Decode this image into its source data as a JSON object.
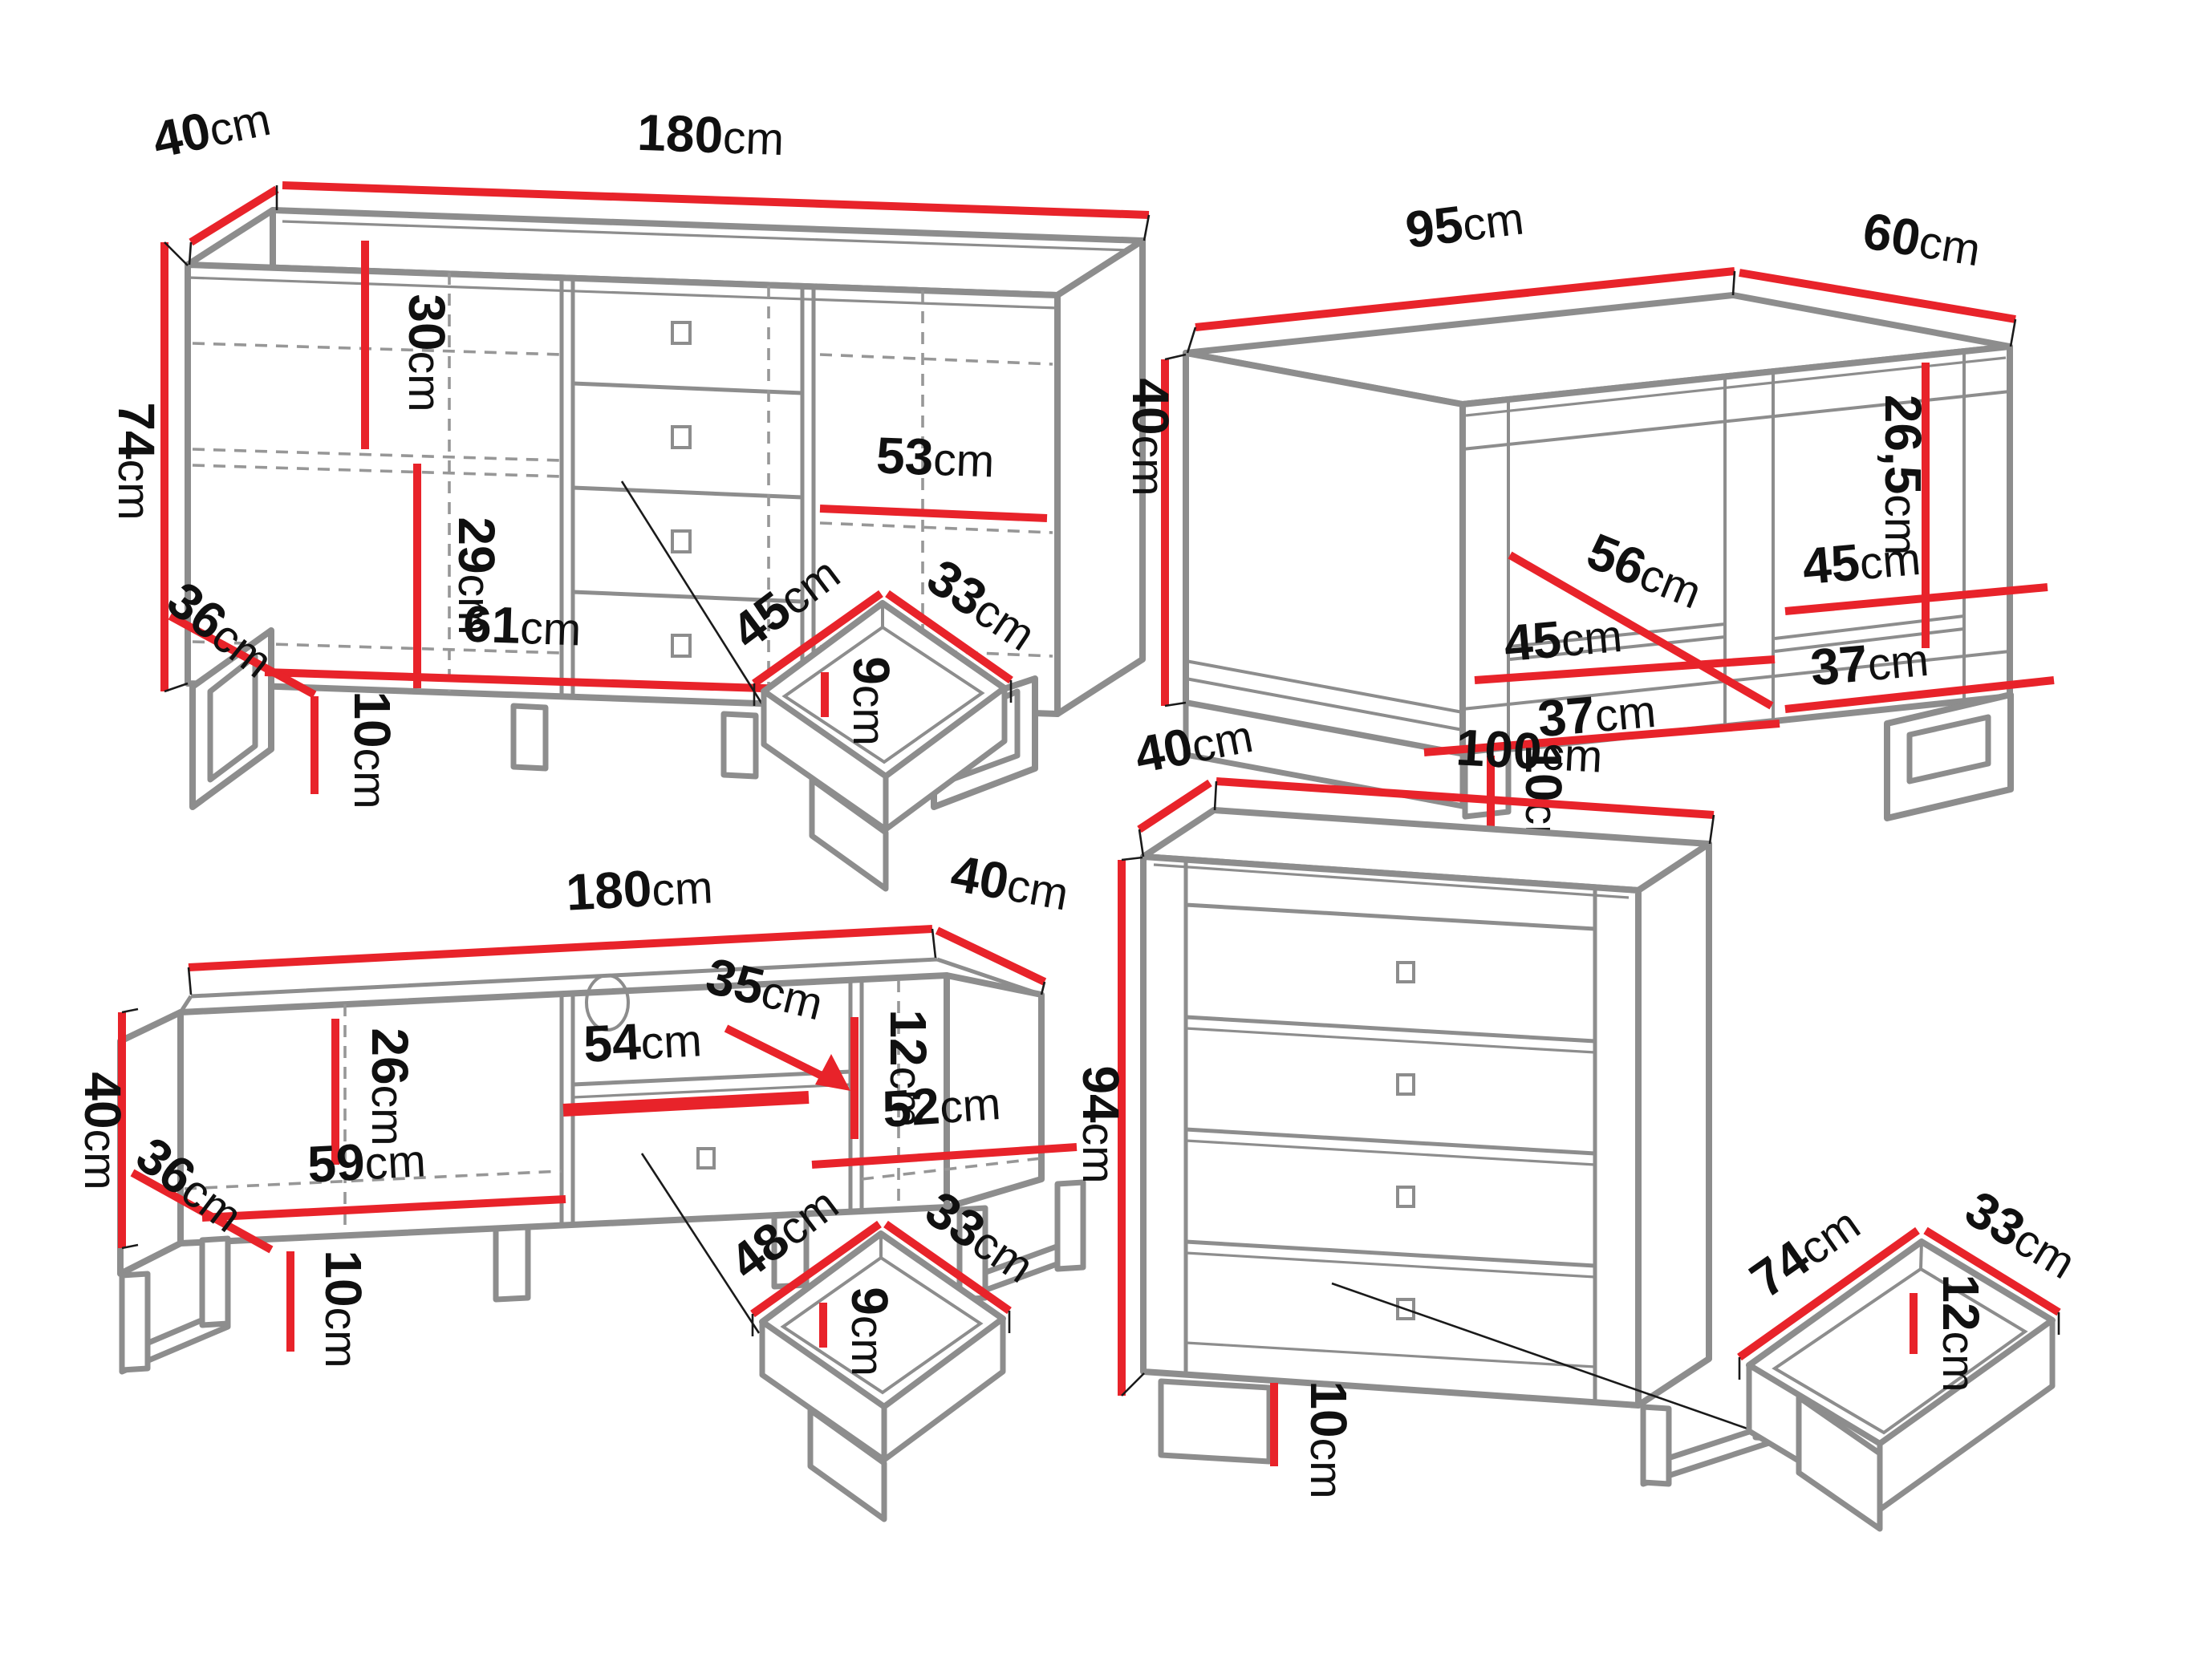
{
  "colors": {
    "dimension_red": "#e8232a",
    "outline_gray": "#8d8d8d",
    "dash_gray": "#979797",
    "label_black": "#101010",
    "page_bg": "#ffffff"
  },
  "unit": "cm",
  "pieces": {
    "sideboard": {
      "name": "sideboard",
      "dims": {
        "depth": {
          "v": "40",
          "u": "cm"
        },
        "width": {
          "v": "180",
          "u": "cm"
        },
        "height": {
          "v": "74",
          "u": "cm"
        },
        "inner_top_height": {
          "v": "30",
          "u": "cm"
        },
        "inner_bottom_height": {
          "v": "29",
          "u": "cm"
        },
        "inner_bottom_width": {
          "v": "61",
          "u": "cm"
        },
        "base_depth": {
          "v": "36",
          "u": "cm"
        },
        "leg_height": {
          "v": "10",
          "u": "cm"
        },
        "shelf_width": {
          "v": "53",
          "u": "cm"
        }
      }
    },
    "sideboard_drawer": {
      "name": "sideboard drawer inside",
      "dims": {
        "width": {
          "v": "45",
          "u": "cm"
        },
        "depth": {
          "v": "33",
          "u": "cm"
        },
        "height": {
          "v": "9",
          "u": "cm"
        }
      }
    },
    "coffee_table": {
      "name": "coffee table",
      "dims": {
        "width": {
          "v": "95",
          "u": "cm"
        },
        "depth": {
          "v": "60",
          "u": "cm"
        },
        "height": {
          "v": "40",
          "u": "cm"
        },
        "inner_height": {
          "v": "26,5",
          "u": "cm"
        },
        "shelf_diagonal": {
          "v": "56",
          "u": "cm"
        },
        "left_shelf_width": {
          "v": "45",
          "u": "cm"
        },
        "left_bottom_width": {
          "v": "37",
          "u": "cm"
        },
        "right_shelf_width": {
          "v": "45",
          "u": "cm"
        },
        "right_bottom_width": {
          "v": "37",
          "u": "cm"
        },
        "leg_height": {
          "v": "10",
          "u": "cm"
        }
      }
    },
    "tv_stand": {
      "name": "TV stand",
      "dims": {
        "width": {
          "v": "180",
          "u": "cm"
        },
        "depth": {
          "v": "40",
          "u": "cm"
        },
        "height": {
          "v": "40",
          "u": "cm"
        },
        "base_depth": {
          "v": "36",
          "u": "cm"
        },
        "inner_height": {
          "v": "26",
          "u": "cm"
        },
        "left_bottom_width": {
          "v": "59",
          "u": "cm"
        },
        "shelf_width": {
          "v": "54",
          "u": "cm"
        },
        "niche_width": {
          "v": "35",
          "u": "cm"
        },
        "niche_height": {
          "v": "12",
          "u": "cm"
        },
        "right_bottom_width": {
          "v": "52",
          "u": "cm"
        },
        "leg_height": {
          "v": "10",
          "u": "cm"
        }
      }
    },
    "tv_stand_drawer": {
      "name": "TV stand drawer inside",
      "dims": {
        "width": {
          "v": "48",
          "u": "cm"
        },
        "depth": {
          "v": "33",
          "u": "cm"
        },
        "height": {
          "v": "9",
          "u": "cm"
        }
      }
    },
    "chest": {
      "name": "chest of drawers",
      "dims": {
        "depth": {
          "v": "40",
          "u": "cm"
        },
        "width": {
          "v": "100",
          "u": "cm"
        },
        "height": {
          "v": "94",
          "u": "cm"
        },
        "leg_height": {
          "v": "10",
          "u": "cm"
        }
      }
    },
    "chest_drawer": {
      "name": "chest drawer inside",
      "dims": {
        "width": {
          "v": "74",
          "u": "cm"
        },
        "depth": {
          "v": "33",
          "u": "cm"
        },
        "height": {
          "v": "12",
          "u": "cm"
        }
      }
    }
  }
}
